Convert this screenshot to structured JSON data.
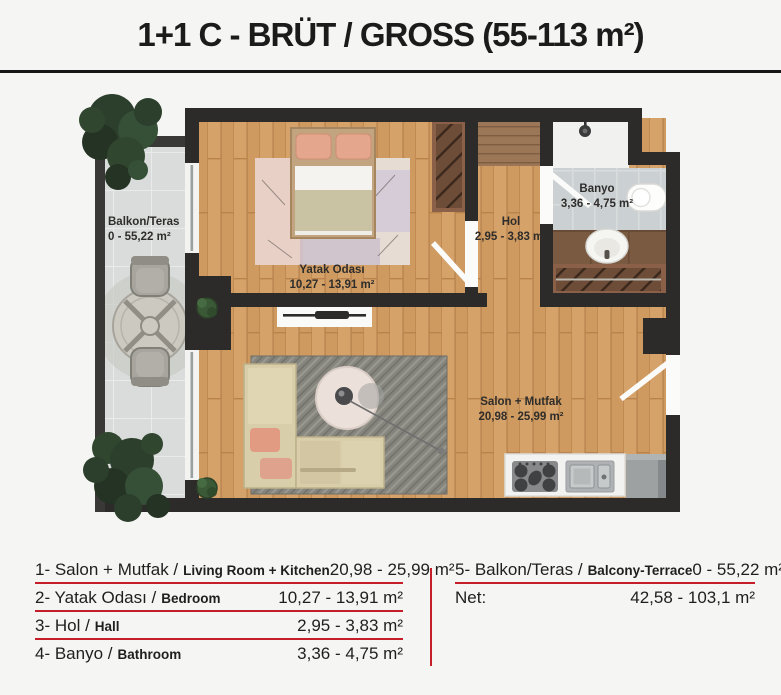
{
  "title": "1+1 C - BRÜT / GROSS (55-113 m²)",
  "plan": {
    "rooms": {
      "balcony": {
        "name": "Balkon/Teras",
        "area": "0 - 55,22 m²"
      },
      "bedroom": {
        "name": "Yatak Odası",
        "area": "10,27 - 13,91 m²"
      },
      "hall": {
        "name": "Hol",
        "area": "2,95 - 3,83 m²"
      },
      "bathroom": {
        "name": "Banyo",
        "area": "3,36 - 4,75 m²"
      },
      "living": {
        "name": "Salon + Mutfak",
        "area": "20,98 - 25,99 m²"
      }
    },
    "colors": {
      "wall": "#2d2b2a",
      "wood_floor": "#d09a5f",
      "balcony_tile": "#d9dcda",
      "bathroom_tile": "#cbd0d2",
      "living_rug": "#85857e",
      "tree_green": "#2c3e2c",
      "accent_red": "#c41e2a"
    }
  },
  "legend": {
    "left": [
      {
        "tr": "1- Salon + Mutfak /",
        "en": "Living Room + Kitchen",
        "value": "20,98 - 25,99 m²"
      },
      {
        "tr": "2- Yatak Odası /",
        "en": "Bedroom",
        "value": "10,27 - 13,91 m²"
      },
      {
        "tr": "3- Hol /",
        "en": "Hall",
        "value": "2,95 - 3,83 m²"
      },
      {
        "tr": "4- Banyo /",
        "en": "Bathroom",
        "value": "3,36 - 4,75 m²"
      }
    ],
    "right": [
      {
        "tr": "5- Balkon/Teras /",
        "en": "Balcony-Terrace",
        "value": "0 - 55,22 m²"
      }
    ],
    "net_label": "Net:",
    "net_value": "42,58 - 103,1 m²"
  }
}
